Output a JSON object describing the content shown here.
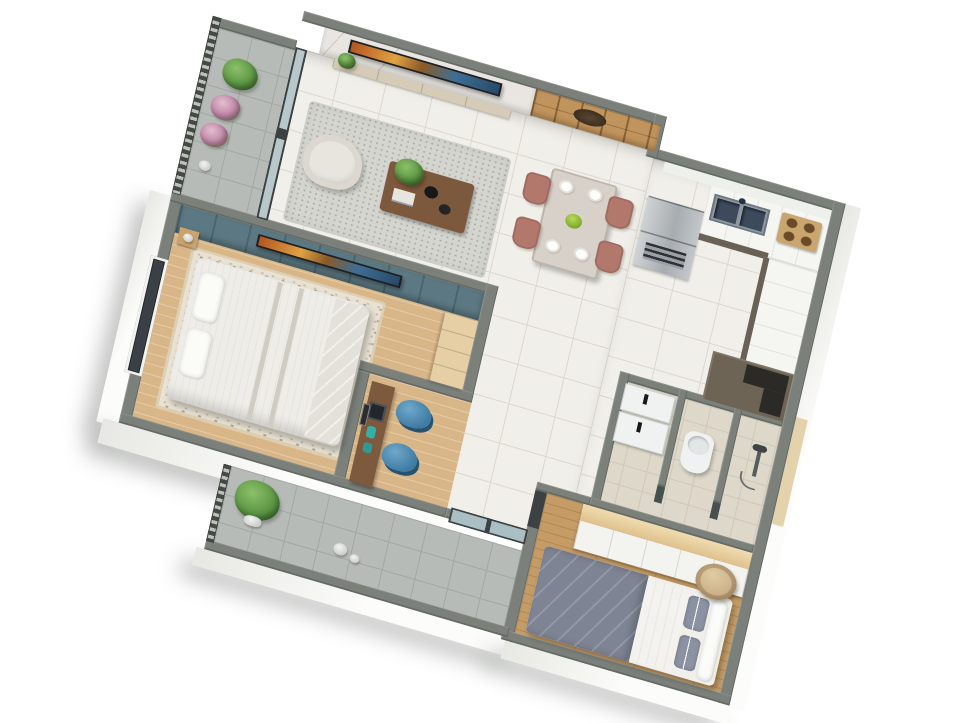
{
  "scene": {
    "type": "isometric-3d-floorplan-render",
    "view": "top-down axonometric, plan rotated ~18 degrees",
    "background": "#ffffff"
  },
  "palette": {
    "wall": "#7b807a",
    "floor_tile": "#f1efe9",
    "grout": "#dcd8cf",
    "balcony_tile": "#b7bbb7",
    "balcony_grout": "#a3a7a3",
    "wood_floor": "#c59c66",
    "wood_plank_line": "#b2884f",
    "master_wood": "#d9b687",
    "rug_floral": "#e9e2d4",
    "teal_wall": "#5c7882",
    "teal_line": "#49656f",
    "marble": "#e9e6e1",
    "slat_wood": "#c0945c",
    "rug_living": "#d5d5d0",
    "sofa": "#e8e5df",
    "coffee_table": "#7c593c",
    "dining_chair": "#b3786c",
    "table_top": "#d8d1c9",
    "fridge": "#b9bdc0",
    "counter": "#f5f5f2",
    "cabinet_dark": "#6a6156",
    "cabinet_black": "#2c2a26",
    "hob_tan": "#c9a66e",
    "sink_steel": "#8e98a0",
    "sink_basin": "#3c4a5c",
    "blue_chair": "#4e8cb4",
    "desk_wood": "#7d5a3d",
    "bed_white": "#efede8",
    "duvet_gray": "#7e8494",
    "pillow_gray": "#8b92a2",
    "wardrobe_top": "#ead0a0",
    "white_furniture": "#f3f3f0",
    "bath_floor": "#ded8ca",
    "fixture_white": "#f0f2f2",
    "plant_green": "#5f9c4a",
    "flower_pink": "#cf9fb7",
    "railing": "#4c514c",
    "glass": "#aabfc4",
    "door_frame": "#3c4141",
    "tv_dark": "#1d1f22",
    "outer_face": "#fbfbf9",
    "pouf_tan": "#cdb38b"
  },
  "rooms": [
    {
      "id": "balcony-top",
      "label": "upper balcony",
      "items": [
        "railing",
        "green potted plant",
        "two pink flowering plants",
        "small white pot"
      ]
    },
    {
      "id": "living-room",
      "label": "living room",
      "items": [
        "marble tv feature wall",
        "flat tv",
        "media console",
        "white armchair",
        "speckled area rug",
        "wood coffee table with plant and bowls",
        "sliding glass door to balcony"
      ]
    },
    {
      "id": "dining-area",
      "label": "dining area",
      "items": [
        "wood slat accent wall with dark ornament",
        "dining table",
        "four mauve chairs",
        "four white plates",
        "green fruit bowl"
      ]
    },
    {
      "id": "kitchen",
      "label": "kitchen",
      "items": [
        "stainless refrigerator",
        "white counter run",
        "double steel sink",
        "four-burner hob",
        "olive lower cabinets",
        "dark corner cabinet"
      ]
    },
    {
      "id": "master-bedroom",
      "label": "master bedroom",
      "items": [
        "teal panel wall with tv",
        "double bed with white striped duvet",
        "two pillows",
        "nightstand",
        "wardrobe",
        "tall dark window",
        "floral rug",
        "wood floor border"
      ]
    },
    {
      "id": "study-nook",
      "label": "study nook",
      "items": [
        "wood desk",
        "laptop",
        "two blue tub chairs",
        "teal desk accessories",
        "leaning framed art"
      ]
    },
    {
      "id": "bathroom",
      "label": "bathroom",
      "items": [
        "two-tier white vanity with black faucets",
        "toilet",
        "shower head with pole",
        "glass partition stubs"
      ]
    },
    {
      "id": "second-bedroom",
      "label": "second bedroom",
      "items": [
        "white wardrobe with wood top",
        "bed with gray-blue duvet",
        "gray and white pillows",
        "round tan pouf",
        "wood plank floor",
        "sliding door"
      ]
    },
    {
      "id": "balcony-bottom",
      "label": "lower balcony",
      "items": [
        "railing",
        "green potted plant",
        "small planters",
        "dark-framed sliding glass door"
      ]
    },
    {
      "id": "hallway",
      "label": "hallway",
      "items": [
        "white floor tiles"
      ]
    }
  ]
}
